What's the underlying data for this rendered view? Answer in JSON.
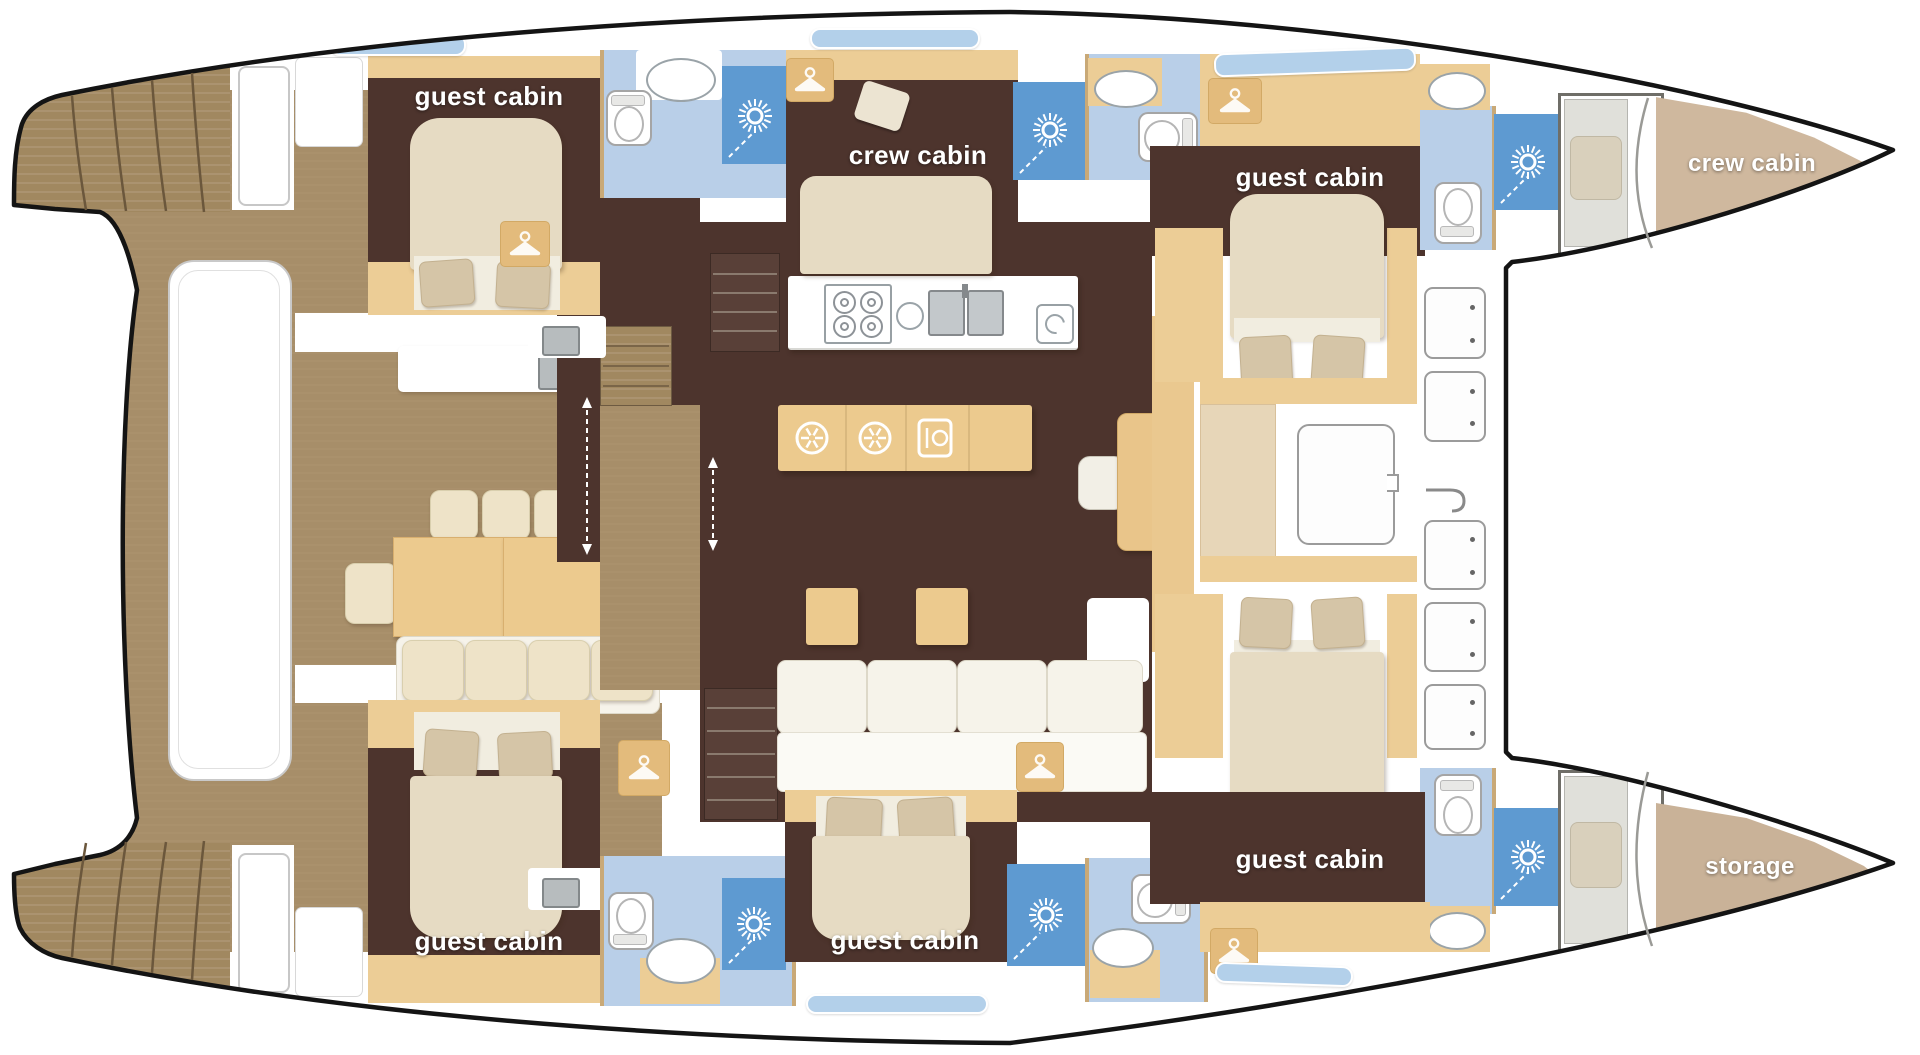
{
  "diagram": {
    "kind": "catamaran yacht deck floor plan",
    "orientation": "bow to the right, twin hulls top and bottom, salon and cockpit on the bridgedeck"
  },
  "rooms": [
    {
      "id": "guest-cabin-top-aft",
      "label": "guest cabin"
    },
    {
      "id": "crew-cabin-mid",
      "label": "crew cabin"
    },
    {
      "id": "guest-cabin-top-fwd",
      "label": "guest cabin"
    },
    {
      "id": "crew-cabin-bow",
      "label": "crew cabin"
    },
    {
      "id": "guest-cabin-bottom-aft",
      "label": "guest cabin"
    },
    {
      "id": "guest-cabin-bottom-mid",
      "label": "guest cabin"
    },
    {
      "id": "guest-cabin-bottom-fwd",
      "label": "guest cabin"
    },
    {
      "id": "storage-bow",
      "label": "storage"
    }
  ],
  "fixtures": {
    "showers": 6,
    "toilets": 6,
    "washbasins": 6,
    "wardrobes": 6,
    "galley": {
      "stove_burners": 4,
      "sinks": 2,
      "refrigerators": 2,
      "dishwasher": 1
    },
    "cockpit": {
      "dining_table_seats_visible": 8
    },
    "foredeck_lockers": 5,
    "beds_double": 6,
    "beds_single": 2
  },
  "icons": [
    "sun-shower-icon",
    "hanger-icon",
    "snowflake-icon",
    "dishwasher-icon",
    "stove-burner-icon",
    "double-sink-icon",
    "companionway-arrow-icon",
    "deck-hook-icon"
  ],
  "colors": {
    "hull_outline": "#141414",
    "teak_deck": "#a78e69",
    "cabin_floor": "#4d342d",
    "furniture_tan": "#eccd96",
    "bed_cream": "#e6dbc3",
    "bathroom_blue": "#b9cfe8",
    "shower_blue": "#5e9ad1",
    "bow_tan": "#cfb89e",
    "window_blue": "#b3d0ea"
  }
}
